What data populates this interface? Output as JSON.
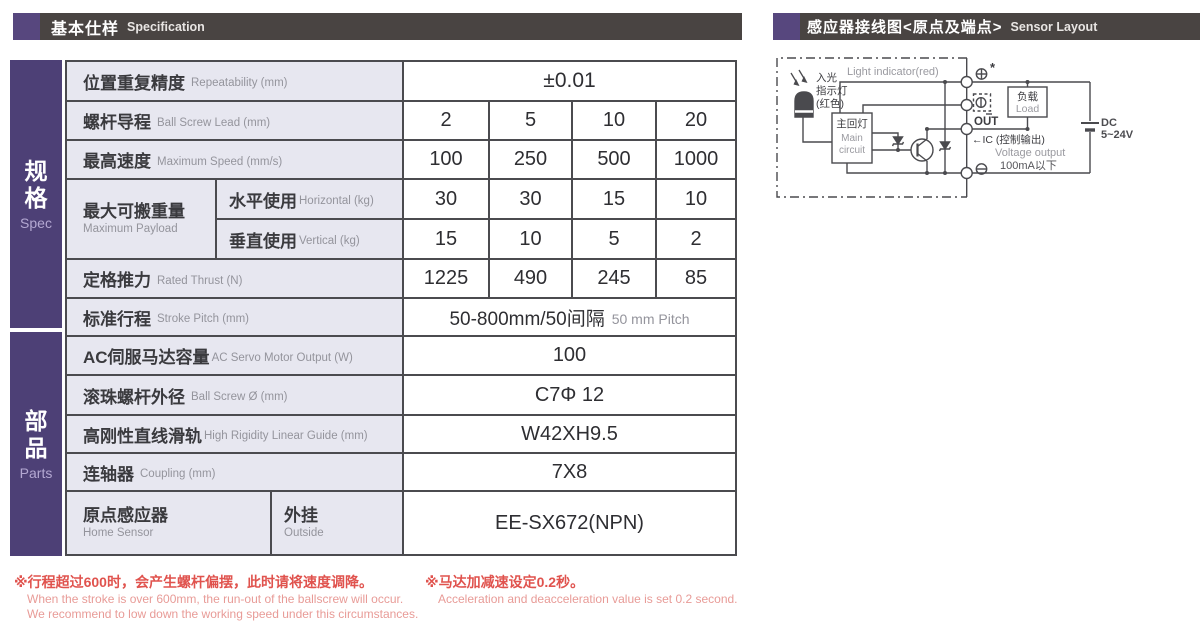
{
  "headers": {
    "left": {
      "zh": "基本仕样",
      "en": "Specification"
    },
    "right": {
      "zh": "感应器接线图<原点及端点>",
      "en": "Sensor Layout"
    }
  },
  "sidebar": {
    "spec": {
      "zh1": "规",
      "zh2": "格",
      "en": "Spec"
    },
    "parts": {
      "zh1": "部",
      "zh2": "品",
      "en": "Parts"
    }
  },
  "table": {
    "repeatability": {
      "zh": "位置重复精度",
      "en": "Repeatability (mm)",
      "value": "±0.01"
    },
    "ball_screw_lead": {
      "zh": "螺杆导程",
      "en": "Ball Screw Lead (mm)",
      "values": [
        "2",
        "5",
        "10",
        "20"
      ]
    },
    "max_speed": {
      "zh": "最高速度",
      "en": "Maximum Speed (mm/s)",
      "values": [
        "100",
        "250",
        "500",
        "1000"
      ]
    },
    "max_payload": {
      "zh": "最大可搬重量",
      "en": "Maximum Payload",
      "horizontal": {
        "zh": "水平使用",
        "en": "Horizontal (kg)",
        "values": [
          "30",
          "30",
          "15",
          "10"
        ]
      },
      "vertical": {
        "zh": "垂直使用",
        "en": "Vertical (kg)",
        "values": [
          "15",
          "10",
          "5",
          "2"
        ]
      }
    },
    "rated_thrust": {
      "zh": "定格推力",
      "en": "Rated Thrust (N)",
      "values": [
        "1225",
        "490",
        "245",
        "85"
      ]
    },
    "stroke": {
      "zh": "标准行程",
      "en": "Stroke Pitch (mm)",
      "value": "50-800mm/50间隔",
      "value_en": "50 mm Pitch"
    },
    "servo_output": {
      "zh": "AC伺服马达容量",
      "en": "AC Servo Motor Output (W)",
      "value": "100"
    },
    "ball_screw_dia": {
      "zh": "滚珠螺杆外径",
      "en": "Ball Screw Ø (mm)",
      "value": "C7Φ 12"
    },
    "linear_guide": {
      "zh": "高刚性直线滑轨",
      "en": "High Rigidity Linear Guide (mm)",
      "value": "W42XH9.5"
    },
    "coupling": {
      "zh": "连轴器",
      "en": "Coupling (mm)",
      "value": "7X8"
    },
    "home_sensor": {
      "zh": "原点感应器",
      "en": "Home Sensor",
      "mount_zh": "外挂",
      "mount_en": "Outside",
      "value": "EE-SX672(NPN)"
    }
  },
  "notes": {
    "note1": {
      "zh": "※行程超过600时，会产生螺杆偏摆，此时请将速度调降。",
      "en1": "When the stroke is over 600mm, the run-out of the ballscrew will occur.",
      "en2": "We recommend to low down the working speed under this circumstances."
    },
    "note2": {
      "zh": "※马达加减速设定0.2秒。",
      "en": "Acceleration and deacceleration value is set 0.2 second."
    }
  },
  "diagram": {
    "light_indicator_en": "Light indicator(red)",
    "light_zh1": "入光",
    "light_zh2": "指示灯",
    "light_zh3": "(红色)",
    "main_circuit_zh": "主回灯",
    "main_circuit_en1": "Main",
    "main_circuit_en2": "circuit",
    "load_zh": "负载",
    "load_en": "Load",
    "out_label": "OUT",
    "ic_label": "←IC (控制输出)",
    "voltage_output": "Voltage output",
    "current_limit": "100mA以下",
    "dc_line1": "DC",
    "dc_line2": "5~24V",
    "star": "*"
  },
  "colors": {
    "header_bar": "#494442",
    "accent_purple": "#57477e",
    "sidebar_purple": "#4d4076",
    "label_bg": "#e7e7f0",
    "grid_border": "#4b4b4f",
    "note_red": "#e0534e",
    "note_red_light": "#e89b97",
    "diagram_line": "#4a4a4e",
    "gray_text": "#94949c"
  }
}
